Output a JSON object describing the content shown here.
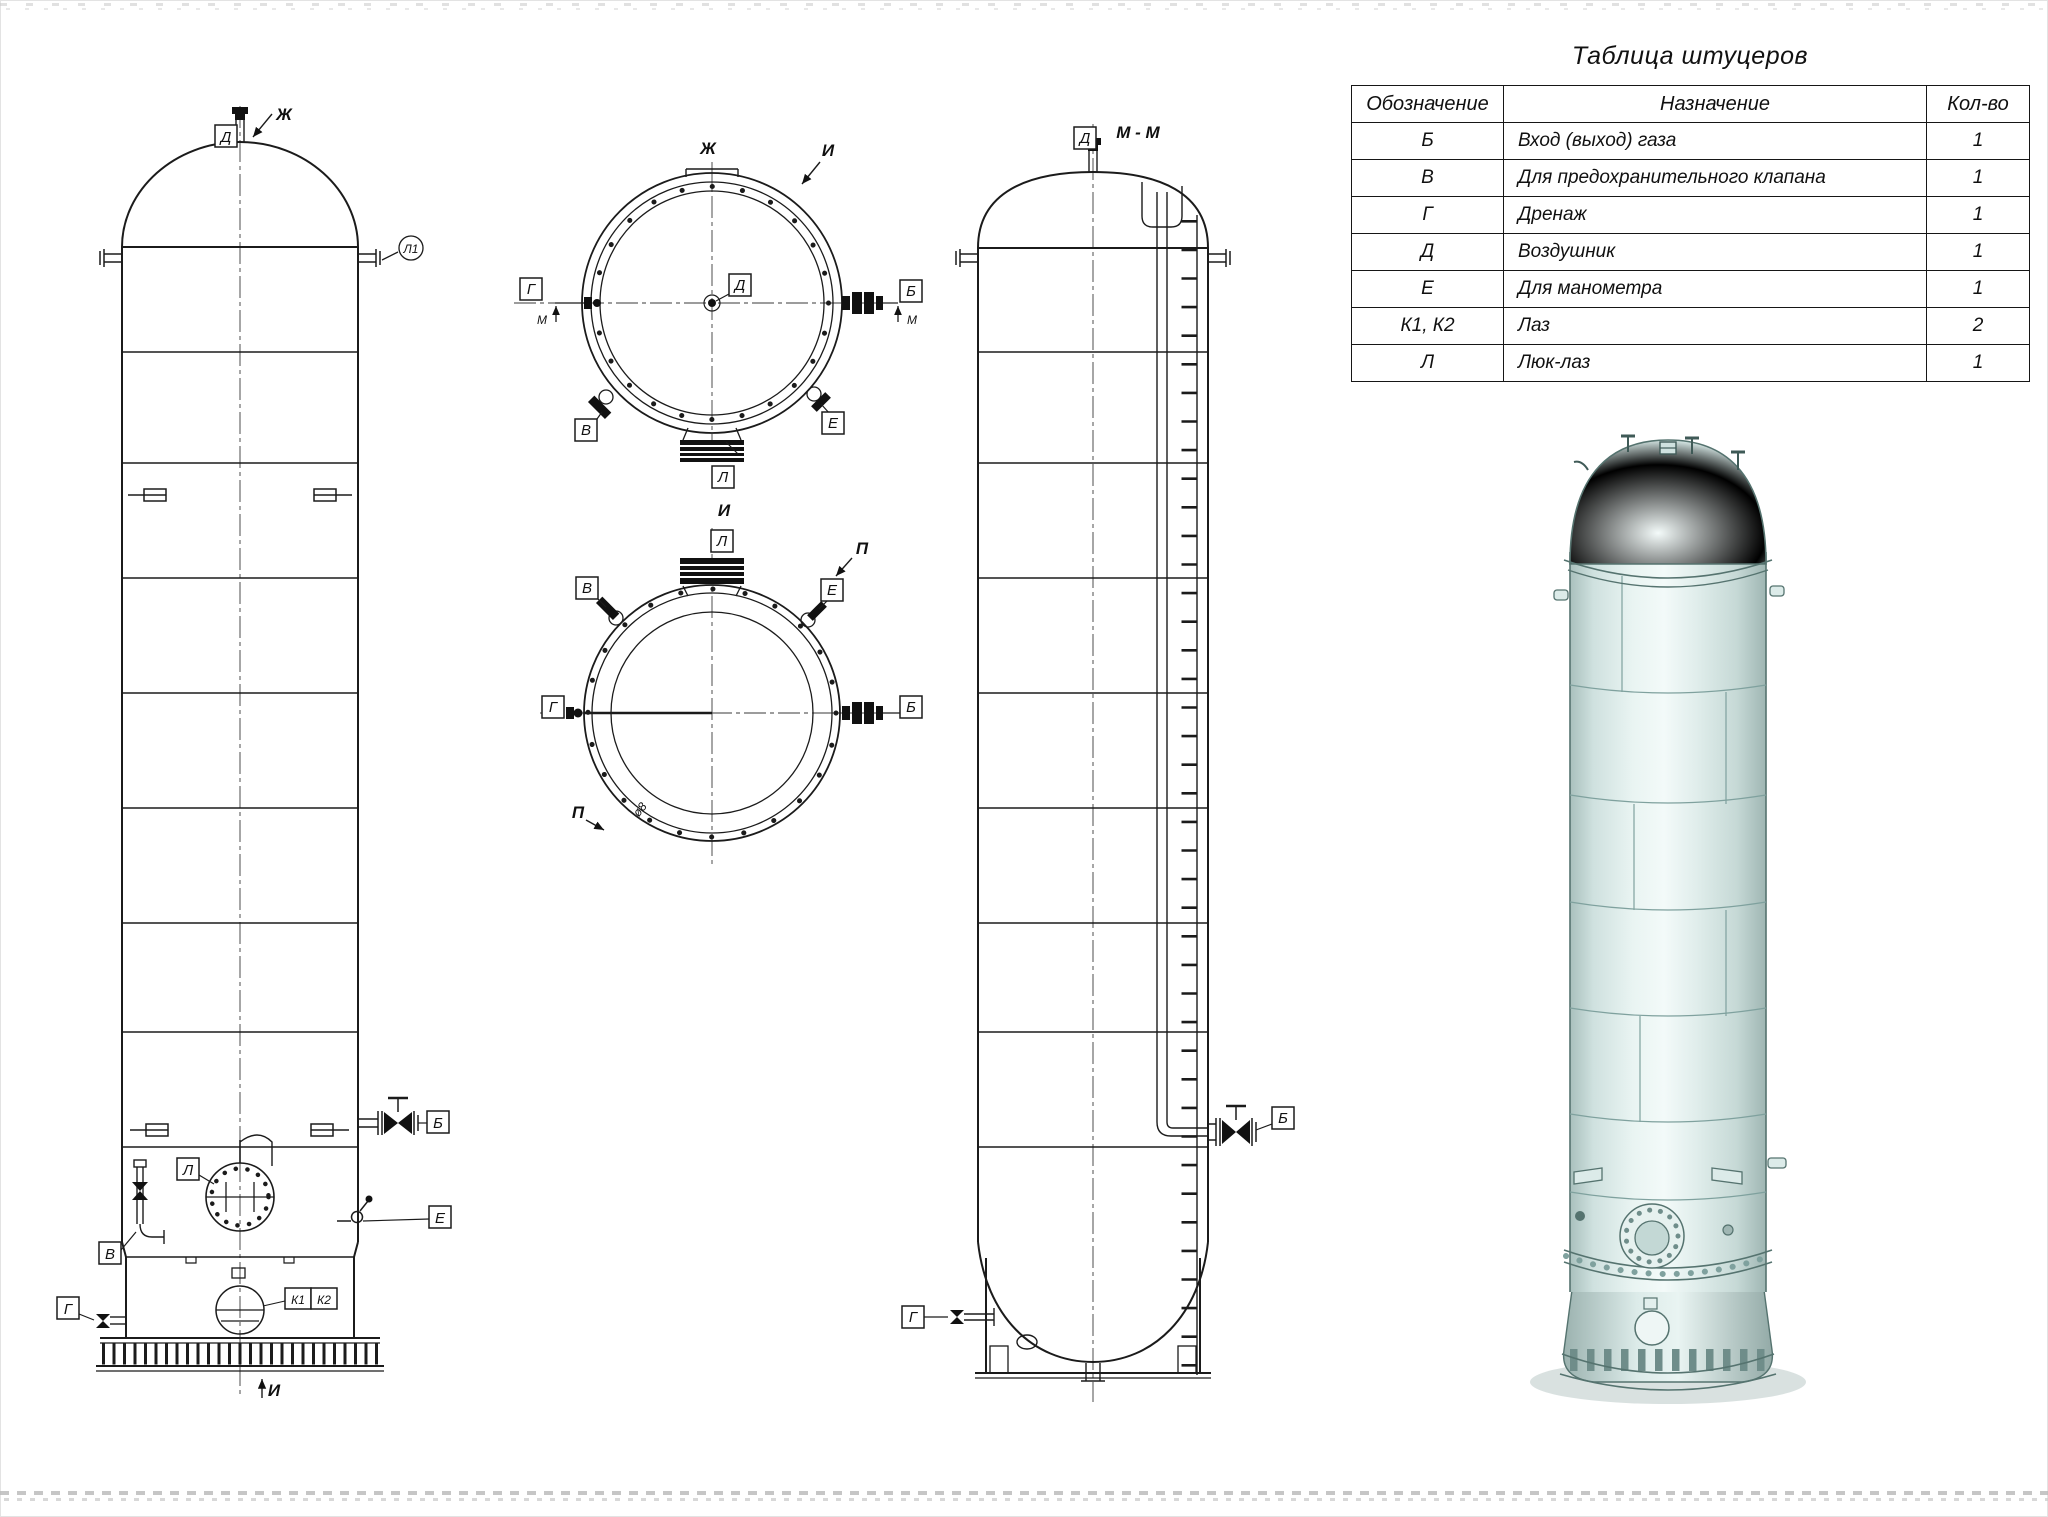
{
  "table": {
    "title": "Таблица штуцеров",
    "headers": {
      "mark": "Обозначение",
      "purpose": "Назначение",
      "qty": "Кол-во"
    },
    "rows": [
      {
        "mark": "Б",
        "purpose": "Вход (выход) газа",
        "qty": "1"
      },
      {
        "mark": "В",
        "purpose": "Для предохранительного клапана",
        "qty": "1"
      },
      {
        "mark": "Г",
        "purpose": "Дренаж",
        "qty": "1"
      },
      {
        "mark": "Д",
        "purpose": "Воздушник",
        "qty": "1"
      },
      {
        "mark": "Е",
        "purpose": "Для манометра",
        "qty": "1"
      },
      {
        "mark": "К1, К2",
        "purpose": "Лаз",
        "qty": "2"
      },
      {
        "mark": "Л",
        "purpose": "Люк-лаз",
        "qty": "1"
      }
    ]
  },
  "views": {
    "front": {
      "labels": {
        "d": "Д",
        "zh": "Ж",
        "balloon": "Л1",
        "b": "Б",
        "l": "Л",
        "e": "Е",
        "v": "В",
        "g": "Г",
        "k1": "К1",
        "k2": "К2",
        "i_marker": "И"
      }
    },
    "top_zh": {
      "labels": {
        "title": "Ж",
        "i_marker": "И",
        "g": "Г",
        "m_left": "М",
        "d": "Д",
        "b": "Б",
        "m_right": "М",
        "v": "В",
        "e": "Е",
        "l": "Л"
      }
    },
    "top_i": {
      "labels": {
        "title": "И",
        "l": "Л",
        "v": "В",
        "e": "Е",
        "p_top": "П",
        "g": "Г",
        "b": "Б",
        "p_bottom": "П",
        "dim": "ø8"
      }
    },
    "side": {
      "labels": {
        "title": "М - М",
        "d": "Д",
        "b": "Б",
        "g": "Г"
      }
    }
  },
  "colors": {
    "line": "#1b1b1b",
    "render_body": "#d9eae8",
    "render_highlight": "#eff8f6",
    "render_shade": "#b2c9c6",
    "render_edge": "#55736f"
  }
}
